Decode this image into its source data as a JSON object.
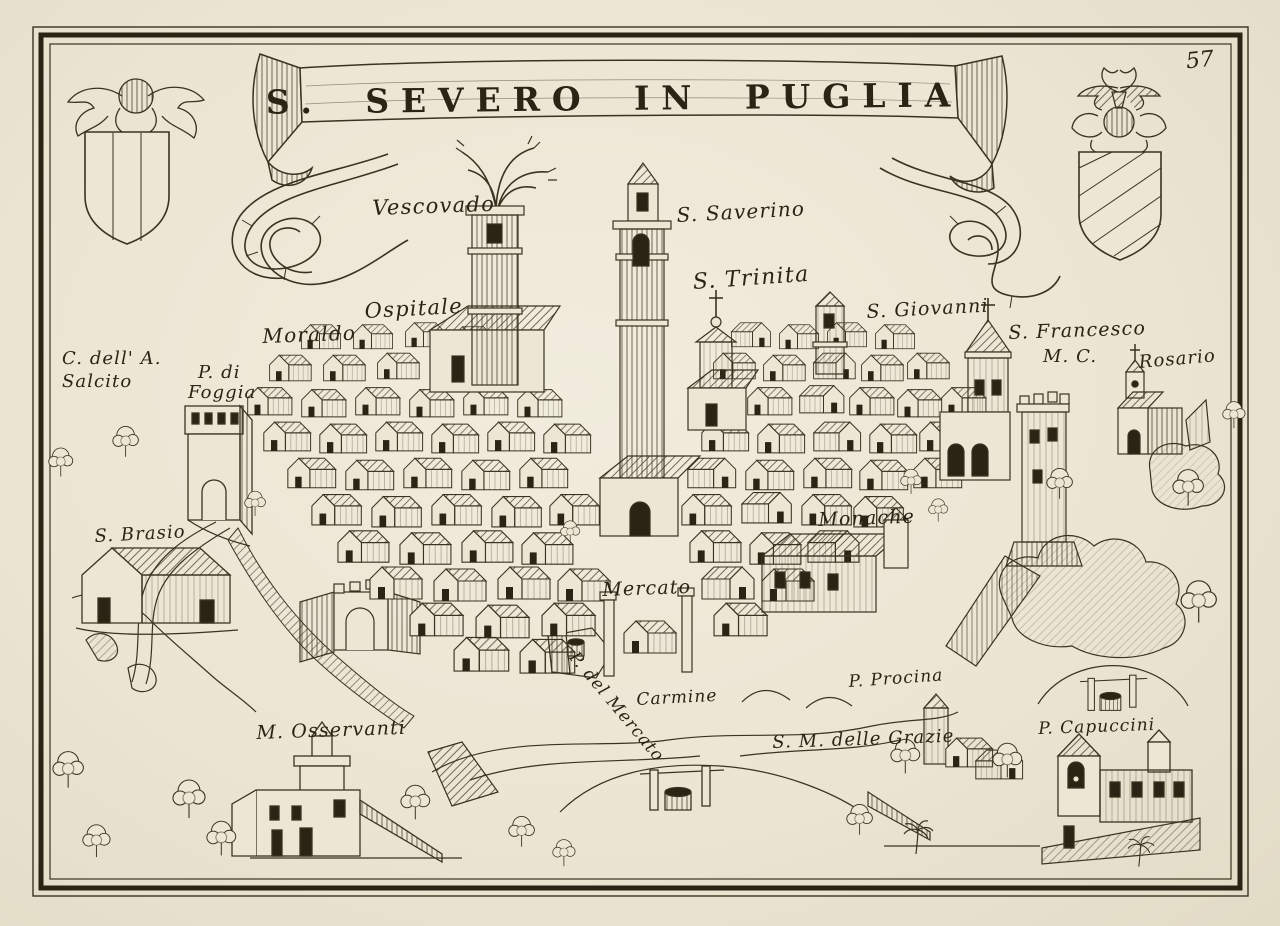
{
  "artwork": {
    "title": "S. SEVERO IN PUGLIA",
    "page_number": "57"
  },
  "palette": {
    "paper": "#ece6d5",
    "ink": "#3a3320",
    "dark": "#2b2414"
  },
  "labels": [
    {
      "text": "Vescovado",
      "x": 372,
      "y": 196,
      "size": 21,
      "rot": -2
    },
    {
      "text": "S. Saverino",
      "x": 676,
      "y": 203,
      "size": 20,
      "rot": -3
    },
    {
      "text": "S. Trinita",
      "x": 692,
      "y": 270,
      "size": 22,
      "rot": -4
    },
    {
      "text": "Ospitale",
      "x": 364,
      "y": 299,
      "size": 21,
      "rot": -3
    },
    {
      "text": "Moraldo",
      "x": 262,
      "y": 324,
      "size": 20,
      "rot": -2
    },
    {
      "text": "S. Giovanni",
      "x": 866,
      "y": 301,
      "size": 19,
      "rot": -3
    },
    {
      "text": "S. Francesco",
      "x": 1008,
      "y": 322,
      "size": 19,
      "rot": -2
    },
    {
      "text": "M. C.",
      "x": 1043,
      "y": 346,
      "size": 18,
      "rot": 0
    },
    {
      "text": "Rosario",
      "x": 1138,
      "y": 352,
      "size": 18,
      "rot": -5
    },
    {
      "text": "C. dell' A.",
      "x": 62,
      "y": 348,
      "size": 18,
      "rot": 0
    },
    {
      "text": "Salcito",
      "x": 62,
      "y": 371,
      "size": 18,
      "rot": 0
    },
    {
      "text": "P. di",
      "x": 198,
      "y": 362,
      "size": 18,
      "rot": 0
    },
    {
      "text": "Foggia",
      "x": 188,
      "y": 382,
      "size": 18,
      "rot": 0
    },
    {
      "text": "S. Brasio",
      "x": 94,
      "y": 526,
      "size": 18,
      "rot": -3
    },
    {
      "text": "Monache",
      "x": 818,
      "y": 509,
      "size": 19,
      "rot": -2
    },
    {
      "text": "Mercato",
      "x": 602,
      "y": 579,
      "size": 19,
      "rot": -2
    },
    {
      "text": "Carmine",
      "x": 636,
      "y": 690,
      "size": 17,
      "rot": -3
    },
    {
      "text": "P. del Mercato",
      "x": 580,
      "y": 648,
      "size": 17,
      "rot": 50
    },
    {
      "text": "P. Procina",
      "x": 848,
      "y": 672,
      "size": 17,
      "rot": -4
    },
    {
      "text": "S. M. delle Grazie",
      "x": 772,
      "y": 732,
      "size": 18,
      "rot": -2
    },
    {
      "text": "M. Osservanti",
      "x": 256,
      "y": 722,
      "size": 19,
      "rot": -2
    },
    {
      "text": "P. Capuccini",
      "x": 1038,
      "y": 719,
      "size": 17,
      "rot": -2
    }
  ]
}
